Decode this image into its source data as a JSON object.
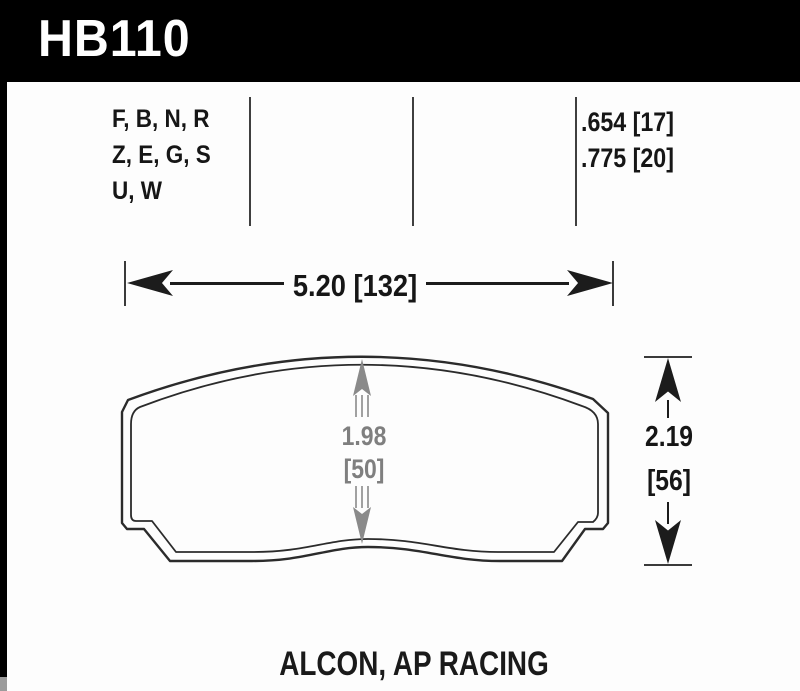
{
  "header": {
    "part_number": "HB110"
  },
  "spec_table": {
    "compounds": [
      "F, B, N, R",
      "Z, E, G, S",
      "U, W"
    ],
    "thickness": [
      ".654 [17]",
      ".775 [20]"
    ]
  },
  "dimensions": {
    "overall_width": "5.20 [132]",
    "center_height_in": "1.98",
    "center_height_mm": "[50]",
    "overall_height_in": "2.19",
    "overall_height_mm": "[56]"
  },
  "footer": {
    "applications": "ALCON, AP RACING"
  },
  "colors": {
    "header_bg": "#000000",
    "header_fg": "#ffffff",
    "drawing_line": "#2b2b2b",
    "dimension_gray": "#7f7f7f"
  },
  "icons": {
    "arrow-left-icon": "barbed-triangle-left",
    "arrow-right-icon": "barbed-triangle-right",
    "arrow-up-icon": "barbed-triangle-up",
    "arrow-down-icon": "barbed-triangle-down"
  }
}
